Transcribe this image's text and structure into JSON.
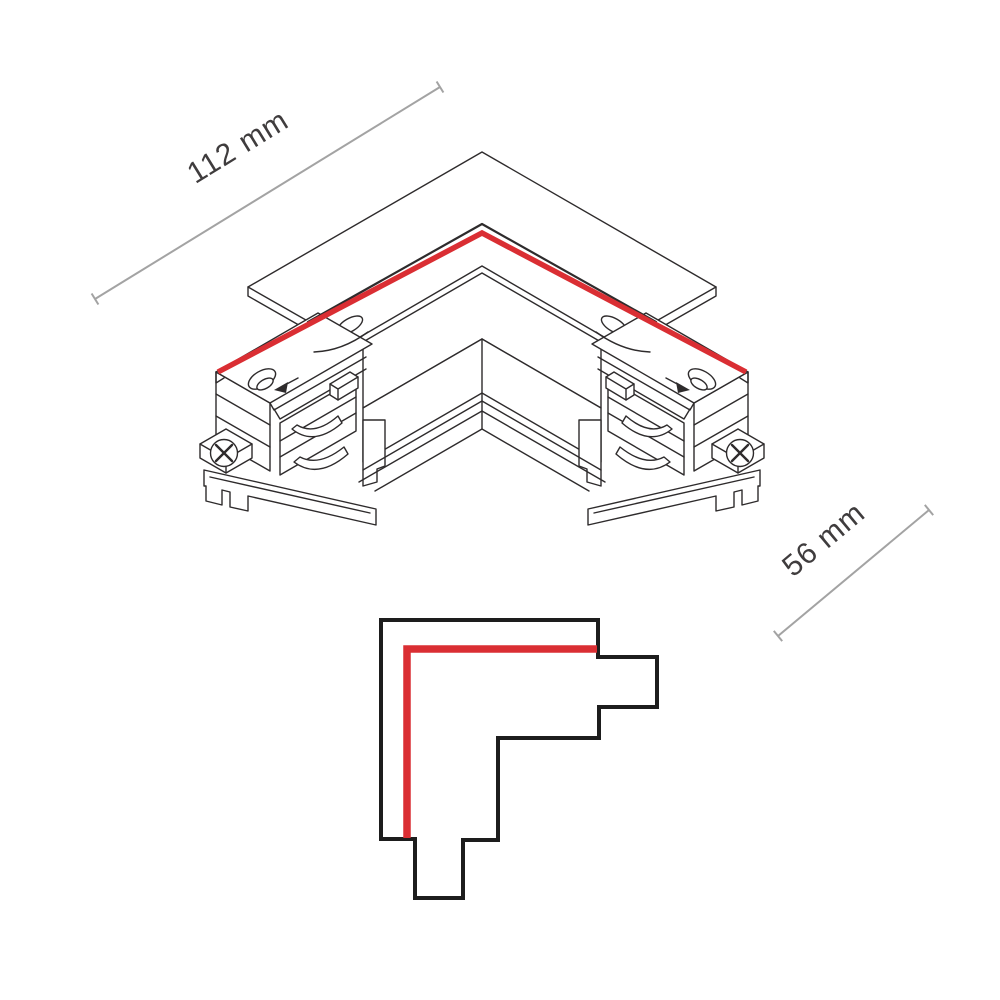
{
  "page": {
    "background": "#ffffff",
    "description_visible_text_only": true
  },
  "dimensions": {
    "width": {
      "label": "112 mm"
    },
    "depth": {
      "label": "56 mm"
    }
  },
  "colors": {
    "accent_red": "#da2e33",
    "drawing_line": "#2e2b2c",
    "schematic_line": "#1d1d1d",
    "dimension_gray": "#a3a3a3",
    "label_text": "#3f3c3d"
  }
}
